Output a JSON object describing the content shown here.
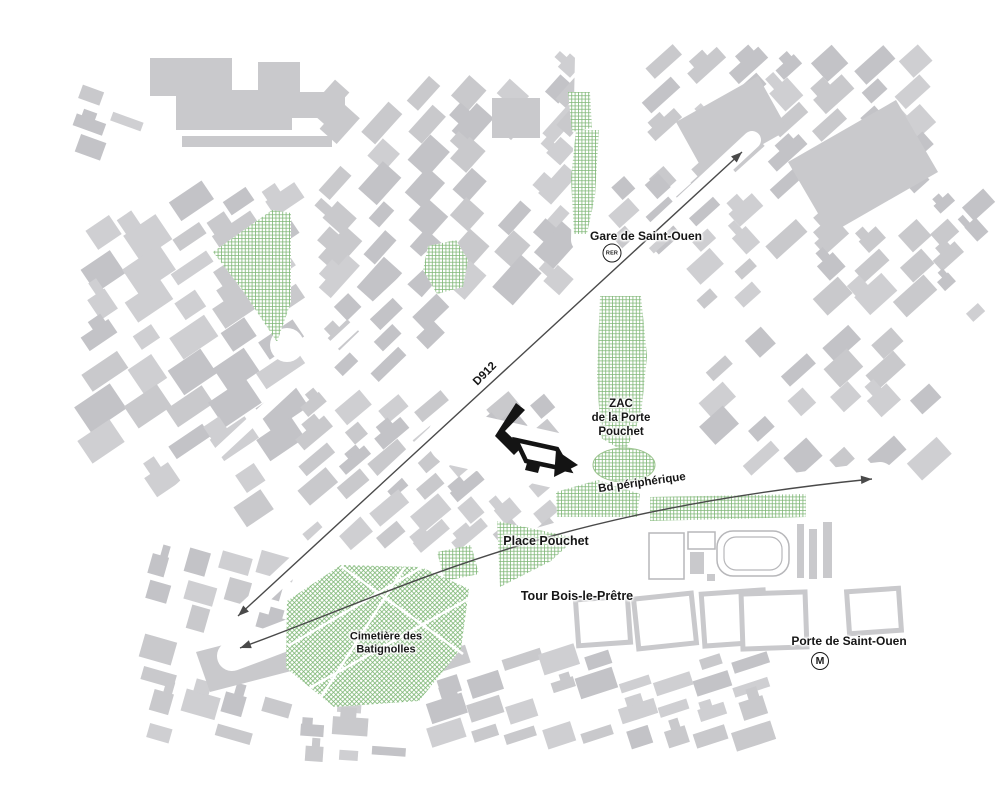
{
  "title": "Plan de situation — ZAC de la Porte Pouchet / Saint-Ouen",
  "colors": {
    "background": "#ffffff",
    "building": "#c9c9cc",
    "building_light": "#cfcfd2",
    "building_dark": "#c3c3c7",
    "block_outline": "#b7b7ba",
    "green": "#66a95c",
    "road_arrow": "#4a4a4a",
    "site_black": "#141414",
    "label_text": "#161616"
  },
  "labels": {
    "gare": {
      "text": "Gare de Saint-Ouen"
    },
    "zac": {
      "l1": "ZAC",
      "l2": "de la Porte",
      "l3": "Pouchet"
    },
    "bd": {
      "text": "Bd périphérique"
    },
    "d912": {
      "text": "D912"
    },
    "place": {
      "text": "Place Pouchet"
    },
    "tour": {
      "text": "Tour Bois-le-Prêtre"
    },
    "cimetiere": {
      "l1": "Cimetière des",
      "l2": "Batignolles"
    },
    "porte": {
      "text": "Porte de Saint-Ouen"
    }
  },
  "icons": {
    "rer": {
      "text": "RER"
    },
    "metro": {
      "text": "M"
    }
  },
  "map": {
    "districts": [
      {
        "x": 85,
        "y": 190,
        "cols": 5,
        "rows": 8,
        "cw": 34,
        "ch": 22,
        "gx": 11,
        "gy": 12,
        "angle": -34,
        "seed": 7,
        "skip": 0.15
      },
      {
        "x": 100,
        "y": 470,
        "cols": 4,
        "rows": 2,
        "cw": 34,
        "ch": 20,
        "gx": 11,
        "gy": 11,
        "angle": -34,
        "seed": 8,
        "skip": 0.2
      },
      {
        "x": 322,
        "y": 82,
        "cols": 6,
        "rows": 7,
        "cw": 32,
        "ch": 20,
        "gx": 12,
        "gy": 11,
        "angle": -48,
        "seed": 3,
        "skip": 0.18
      },
      {
        "x": 330,
        "y": 300,
        "cols": 3,
        "rows": 3,
        "cw": 30,
        "ch": 18,
        "gx": 12,
        "gy": 10,
        "angle": -44,
        "seed": 12,
        "skip": 0.2
      },
      {
        "x": 648,
        "y": 55,
        "cols": 7,
        "rows": 9,
        "cw": 30,
        "ch": 18,
        "gx": 12,
        "gy": 11,
        "angle": -42,
        "seed": 5,
        "skip": 0.2
      },
      {
        "x": 702,
        "y": 332,
        "cols": 6,
        "rows": 5,
        "cw": 30,
        "ch": 18,
        "gx": 12,
        "gy": 11,
        "angle": -42,
        "seed": 9,
        "skip": 0.2
      },
      {
        "x": 302,
        "y": 398,
        "cols": 7,
        "rows": 6,
        "cw": 28,
        "ch": 16,
        "gx": 10,
        "gy": 10,
        "angle": -40,
        "seed": 4,
        "skip": 0.18
      },
      {
        "x": 146,
        "y": 556,
        "cols": 4,
        "rows": 7,
        "cw": 28,
        "ch": 18,
        "gx": 10,
        "gy": 10,
        "angle": 16,
        "seed": 6,
        "skip": 0.2
      },
      {
        "x": 432,
        "y": 652,
        "cols": 9,
        "rows": 4,
        "cw": 30,
        "ch": 16,
        "gx": 8,
        "gy": 9,
        "angle": -18,
        "seed": 10,
        "skip": 0.15
      },
      {
        "x": 936,
        "y": 198,
        "cols": 2,
        "rows": 5,
        "cw": 22,
        "ch": 16,
        "gx": 8,
        "gy": 10,
        "angle": -42,
        "seed": 13,
        "skip": 0.2
      },
      {
        "x": 80,
        "y": 90,
        "cols": 2,
        "rows": 3,
        "cw": 24,
        "ch": 14,
        "gx": 10,
        "gy": 12,
        "angle": 20,
        "seed": 14,
        "skip": 0.25
      },
      {
        "x": 302,
        "y": 698,
        "cols": 3,
        "rows": 3,
        "cw": 26,
        "ch": 14,
        "gx": 10,
        "gy": 10,
        "angle": 4,
        "seed": 15,
        "skip": 0.25
      },
      {
        "x": 612,
        "y": 182,
        "cols": 3,
        "rows": 3,
        "cw": 24,
        "ch": 14,
        "gx": 10,
        "gy": 10,
        "angle": -42,
        "seed": 16,
        "skip": 0.25
      },
      {
        "x": 560,
        "y": 60,
        "cols": 2,
        "rows": 3,
        "cw": 24,
        "ch": 16,
        "gx": 10,
        "gy": 10,
        "angle": -48,
        "seed": 17,
        "skip": 0.3
      }
    ],
    "buildings": [
      [
        [
          150,
          58
        ],
        [
          232,
          58
        ],
        [
          232,
          90
        ],
        [
          258,
          90
        ],
        [
          258,
          62
        ],
        [
          300,
          62
        ],
        [
          300,
          92
        ],
        [
          345,
          92
        ],
        [
          345,
          118
        ],
        [
          292,
          118
        ],
        [
          292,
          130
        ],
        [
          176,
          130
        ],
        [
          176,
          96
        ],
        [
          150,
          96
        ]
      ],
      [
        [
          182,
          136
        ],
        [
          332,
          136
        ],
        [
          332,
          147
        ],
        [
          182,
          147
        ]
      ],
      [
        [
          788,
          162
        ],
        [
          896,
          100
        ],
        [
          938,
          172
        ],
        [
          830,
          234
        ]
      ],
      [
        [
          676,
          122
        ],
        [
          758,
          76
        ],
        [
          788,
          130
        ],
        [
          706,
          176
        ]
      ],
      [
        [
          196,
          652
        ],
        [
          312,
          622
        ],
        [
          326,
          662
        ],
        [
          210,
          692
        ]
      ],
      [
        [
          492,
          98
        ],
        [
          540,
          98
        ],
        [
          540,
          138
        ],
        [
          492,
          138
        ]
      ]
    ],
    "carves": {
      "lines": [
        {
          "x1": 225,
          "y1": 630,
          "x2": 752,
          "y2": 140,
          "w": 18
        },
        {
          "x1": 148,
          "y1": 518,
          "x2": 434,
          "y2": 252,
          "w": 11
        },
        {
          "x1": 587,
          "y1": 56,
          "x2": 583,
          "y2": 240,
          "w": 24
        },
        {
          "x1": 654,
          "y1": 292,
          "x2": 662,
          "y2": 484,
          "w": 13
        },
        {
          "x1": 455,
          "y1": 438,
          "x2": 598,
          "y2": 470,
          "w": 55
        },
        {
          "x1": 588,
          "y1": 232,
          "x2": 602,
          "y2": 300,
          "w": 20
        }
      ],
      "paths": [
        {
          "d": "M232,656 C420,588 545,514 880,477",
          "w": 30
        }
      ],
      "circles": [
        {
          "cx": 287,
          "cy": 345,
          "r": 17
        }
      ]
    },
    "greens": [
      {
        "pts": [
          [
            272,
            210
          ],
          [
            291,
            213
          ],
          [
            291,
            302
          ],
          [
            277,
            342
          ],
          [
            241,
            288
          ],
          [
            213,
            252
          ]
        ],
        "pattern": "grid"
      },
      {
        "pts": [
          [
            428,
            246
          ],
          [
            456,
            240
          ],
          [
            468,
            260
          ],
          [
            463,
            287
          ],
          [
            437,
            294
          ],
          [
            423,
            270
          ]
        ],
        "pattern": "grid"
      },
      {
        "pts": [
          [
            576,
            130
          ],
          [
            599,
            130
          ],
          [
            595,
            196
          ],
          [
            587,
            234
          ],
          [
            574,
            234
          ],
          [
            571,
            178
          ]
        ],
        "pattern": "grid"
      },
      {
        "pts": [
          [
            568,
            92
          ],
          [
            590,
            92
          ],
          [
            592,
            128
          ],
          [
            572,
            132
          ]
        ],
        "pattern": "grid"
      },
      {
        "pts": [
          [
            600,
            296
          ],
          [
            641,
            296
          ],
          [
            647,
            356
          ],
          [
            641,
            416
          ],
          [
            625,
            452
          ],
          [
            601,
            438
          ],
          [
            597,
            376
          ]
        ],
        "pattern": "grid"
      },
      {
        "ellipse": [
          624,
          465,
          31,
          17
        ],
        "pattern": "grid",
        "stroke": true
      },
      {
        "pts": [
          [
            556,
            492
          ],
          [
            598,
            480
          ],
          [
            640,
            494
          ],
          [
            637,
            517
          ],
          [
            557,
            517
          ]
        ],
        "pattern": "grid"
      },
      {
        "pts": [
          [
            650,
            497
          ],
          [
            806,
            494
          ],
          [
            806,
            517
          ],
          [
            650,
            521
          ]
        ],
        "pattern": "grid"
      },
      {
        "pts": [
          [
            497,
            521
          ],
          [
            576,
            538
          ],
          [
            551,
            561
          ],
          [
            500,
            587
          ]
        ],
        "pattern": "grid"
      },
      {
        "pts": [
          [
            437,
            552
          ],
          [
            471,
            545
          ],
          [
            479,
            574
          ],
          [
            445,
            581
          ]
        ],
        "pattern": "grid"
      },
      {
        "pts": [
          [
            287,
            601
          ],
          [
            341,
            565
          ],
          [
            421,
            567
          ],
          [
            469,
            589
          ],
          [
            461,
            649
          ],
          [
            419,
            701
          ],
          [
            334,
            707
          ],
          [
            286,
            668
          ]
        ],
        "pattern": "cem",
        "paths": [
          [
            288,
            646,
            424,
            566
          ],
          [
            306,
            690,
            470,
            598
          ],
          [
            341,
            566,
            463,
            654
          ],
          [
            404,
            568,
            318,
            702
          ]
        ]
      }
    ],
    "stadium": {
      "outlined": [
        [
          649,
          533,
          35,
          46
        ],
        [
          688,
          532,
          27,
          17
        ]
      ],
      "track_outer": [
        717,
        531,
        72,
        45,
        16
      ],
      "track_inner": [
        724,
        537,
        58,
        33,
        12
      ],
      "gray": [
        [
          690,
          552,
          14,
          22
        ],
        [
          797,
          524,
          7,
          54
        ],
        [
          809,
          529,
          8,
          50
        ],
        [
          707,
          574,
          8,
          7
        ],
        [
          823,
          522,
          9,
          56
        ]
      ]
    },
    "hollow": [
      [
        577,
        598,
        52,
        46,
        -4
      ],
      [
        636,
        596,
        58,
        50,
        -6
      ],
      [
        703,
        592,
        62,
        52,
        -4
      ],
      [
        742,
        593,
        64,
        55,
        -2
      ],
      [
        848,
        590,
        52,
        42,
        -4
      ]
    ],
    "arrows": [
      {
        "line": [
          238,
          616,
          742,
          152
        ],
        "heads": [
          [
            742,
            152,
            -42.6
          ],
          [
            238,
            616,
            137.4
          ]
        ]
      },
      {
        "path": "M 240,648 C 420,582 545,512 872,479",
        "heads": [
          [
            872,
            479,
            -4
          ],
          [
            240,
            648,
            160
          ]
        ]
      }
    ],
    "site": {
      "bar": "M516,403 L525,410 L505,431 L522,447 L514,455 L495,436 Z",
      "quad": "M516,440 L557,449 L569,470 L526,461 Z",
      "tri": "M556,450 L578,465 L554,477 Z",
      "notch": "M527,463 L540,466 L538,473 L525,470 Z"
    }
  }
}
